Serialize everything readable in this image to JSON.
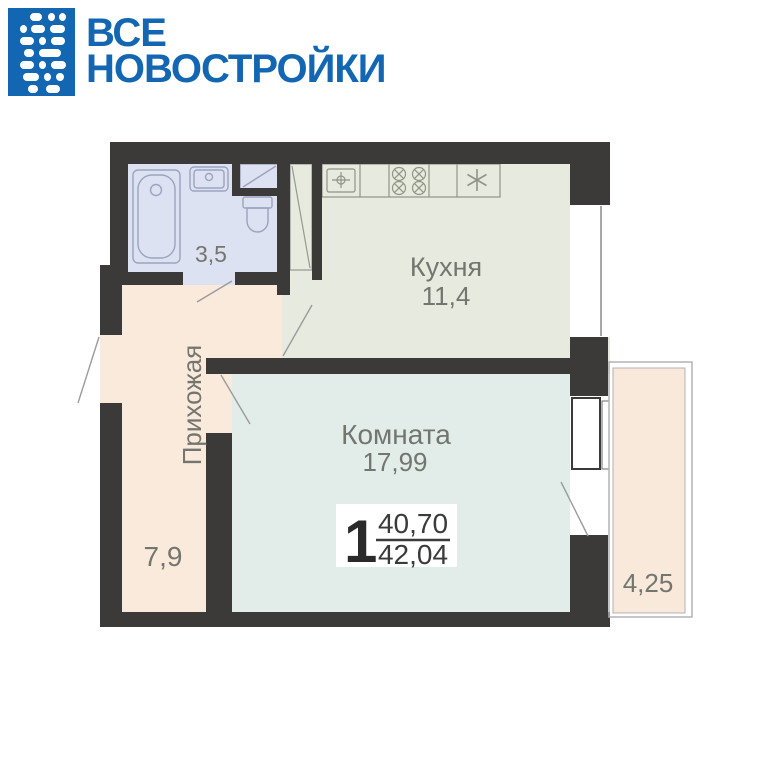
{
  "logo": {
    "line1": "ВСЕ",
    "line2": "НОВОСТРОЙКИ"
  },
  "colors": {
    "brand_blue": "#1266b2",
    "wall": "#3b3a38",
    "bathroom_floor": "#dde2f3",
    "kitchen_floor": "#e7ebdf",
    "hallway_floor": "#faeadb",
    "room_floor": "#e2edea",
    "balcony_floor": "#f8e9da",
    "label_gray": "#73766f",
    "badge_text": "#3a3a3a"
  },
  "plan": {
    "bathroom": {
      "area": "3,5"
    },
    "kitchen": {
      "name": "Кухня",
      "area": "11,4"
    },
    "hallway": {
      "name": "Прихожая",
      "area": "7,9"
    },
    "room": {
      "name": "Комната",
      "area": "17,99"
    },
    "balcony": {
      "area": "4,25"
    },
    "badge": {
      "rooms_count": "1",
      "living_area": "40,70",
      "total_area": "42,04"
    }
  }
}
